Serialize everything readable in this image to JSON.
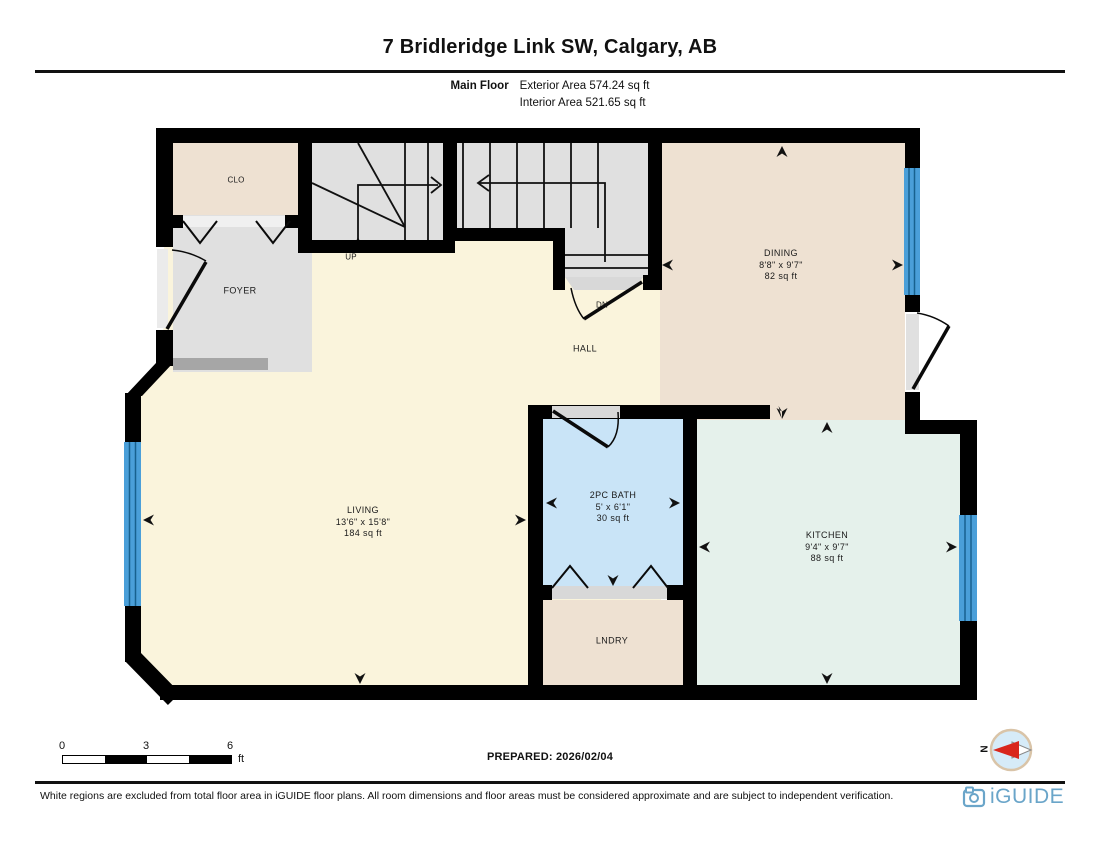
{
  "header": {
    "title": "7 Bridleridge Link SW, Calgary, AB",
    "floor_label": "Main Floor",
    "exterior_area": "Exterior Area 574.24 sq ft",
    "interior_area": "Interior Area 521.65 sq ft"
  },
  "rooms": {
    "living": {
      "name": "LIVING",
      "dims": "13'6\" x 15'8\"",
      "area": "184 sq ft"
    },
    "dining": {
      "name": "DINING",
      "dims": "8'8\" x 9'7\"",
      "area": "82 sq ft"
    },
    "kitchen": {
      "name": "KITCHEN",
      "dims": "9'4\" x 9'7\"",
      "area": "88 sq ft"
    },
    "bath": {
      "name": "2PC BATH",
      "dims": "5' x 6'1\"",
      "area": "30 sq ft"
    },
    "foyer": {
      "name": "FOYER"
    },
    "closet": {
      "name": "CLO"
    },
    "hall": {
      "name": "HALL"
    },
    "laundry": {
      "name": "LNDRY"
    },
    "stairs_up": {
      "name": "UP"
    },
    "stairs_down": {
      "name": "DN"
    }
  },
  "scale_bar": {
    "tick_0": "0",
    "tick_3": "3",
    "tick_6": "6",
    "unit": "ft"
  },
  "prepared_label": "PREPARED: 2026/02/04",
  "compass": {
    "north_label": "N"
  },
  "footer": {
    "disclaimer": "White regions are excluded from total floor area in iGUIDE floor plans. All room dimensions and floor areas must be considered approximate and are subject to independent verification.",
    "brand": "iGUIDE"
  },
  "colors": {
    "wall": "#000000",
    "floor_cream": "#faf4dc",
    "floor_beige": "#eee1d2",
    "floor_gray": "#e0e0e0",
    "floor_bath_blue": "#c9e4f7",
    "floor_kitchen_mint": "#e5f1eb",
    "window_blue": "#4a9fd9",
    "compass_red": "#d9261c",
    "compass_ring": "#d9c4a8",
    "brand_blue": "#6aa5c9"
  }
}
